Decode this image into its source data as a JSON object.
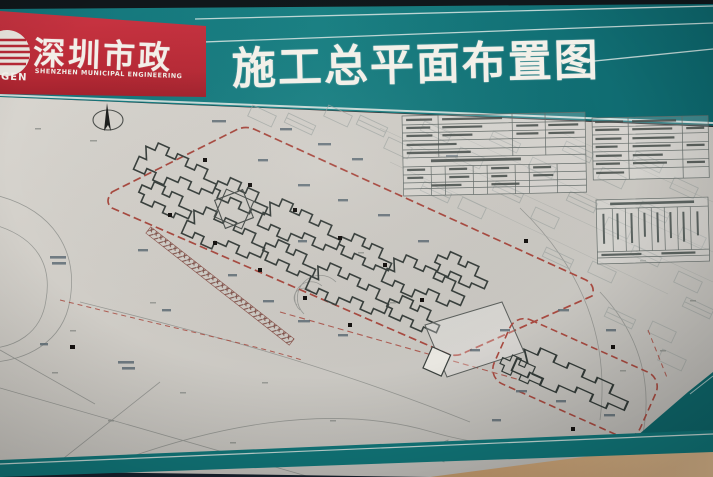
{
  "board": {
    "brand_panel": {
      "emblem_text": "GEN",
      "name_cn": "深圳市政",
      "name_en": "SHENZHEN MUNICIPAL ENGINEERING"
    },
    "banner": {
      "title": "施工总平面布置图"
    },
    "colors": {
      "banner_green": "#17797d",
      "brand_red": "#c02e3a",
      "paper_gray": "#cdcac4",
      "site_boundary_red": "#a84a40",
      "building_outline": "#3b4240",
      "frame_navy": "#1b2531",
      "corner_tan": "#cfa57b"
    }
  }
}
